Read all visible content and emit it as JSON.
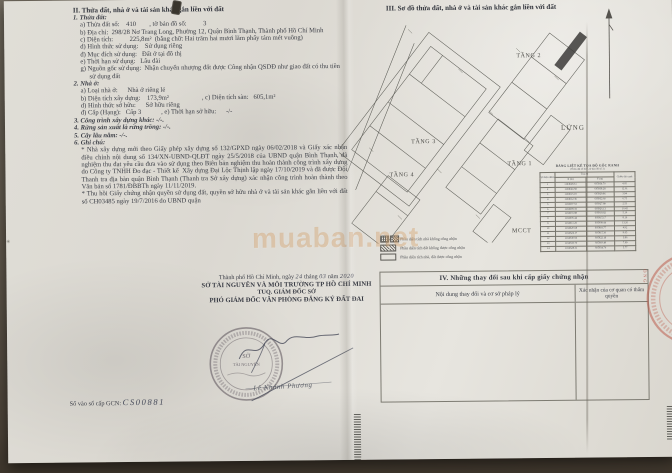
{
  "document": {
    "section2": {
      "heading": "II. Thửa đất, nhà ở và tài sản khác gắn liền với đất",
      "parcel": {
        "title": "1. Thửa đất:",
        "lines": [
          "a) Thửa đất số:    410        , tờ bản đồ số:          3",
          "b) Địa chỉ:  298/28 Nơ Trang Long, Phường 12, Quận Bình Thạnh, Thành phố Hồ Chí Minh",
          "c) Diện tích:          225,8m²  (bằng chữ: Hai trăm hai mươi lăm phẩy tám mét vuông)",
          "d) Hình thức sử dụng:    Sử dụng riêng",
          "đ) Mục đích sử dụng:   Đất ở tại đô thị",
          "e) Thời hạn sử dụng:   Lâu dài",
          "g) Nguồn gốc sử dụng:  Nhận chuyển nhượng đất được Công nhận QSDĐ như giao đất có thu tiền sử dụng đất"
        ]
      },
      "house": {
        "title": "2. Nhà ở:",
        "lines": [
          "a) Loại nhà ở:      Nhà ở riêng lẻ",
          "b) Diện tích xây dựng:    173,9m²                    , c) Diện tích sàn:   605,1m²",
          "d) Hình thức sở hữu:      Sở hữu riêng",
          "đ) Cấp (Hạng):   Cấp 3            , e) Thời hạn sở hữu:      -/-"
        ]
      },
      "other_constructions": "3. Công trình xây dựng khác: -/-.",
      "forest": "4. Rừng sản xuất là rừng trồng: -/-.",
      "perennial": "5. Cây lâu năm: -/-.",
      "notes_title": "6. Ghi chú:",
      "notes": [
        "* Nhà xây dựng mới theo Giấy phép xây dựng số 132/GPXD ngày 06/02/2018 và Giấy xác nhận điều chỉnh nội dung số 134/XN-UBND-QLĐT ngày 25/5/2018 của UBND quận Bình Thạnh, đã nghiệm thu đạt yêu cầu đưa vào sử dụng theo Biên bản nghiệm thu hoàn thành công trình xây dựng do Công ty TNHH Đo đạc - Thiết kế  Xây dựng Đại Lộc Thịnh lập ngày 17/10/2019 và đã được Đội Thanh tra địa bàn quận Bình Thạnh (Thanh tra Sở xây dựng) xác nhận công trình hoàn thành theo Văn bản số 1781/ĐBBTh ngày 11/11/2019.",
        "* Thu hồi Giấy chứng nhận quyền sử dụng đất, quyền sở hữu nhà ở và tài sản khác gắn liền với đất số CH03485 ngày 19/7/2016 do UBND quận"
      ]
    },
    "signature_block": {
      "date_pre": "Thành phố Hồ Chí Minh, ngày",
      "date_day": "24",
      "date_thang": "tháng",
      "date_month": "03",
      "date_nam": "năm",
      "date_year": "2020",
      "org": "SỞ TÀI NGUYÊN VÀ MÔI TRƯỜNG TP HỒ CHÍ MINH",
      "delegation": "TUQ. GIÁM ĐỐC SỞ",
      "signer_title": "PHÓ GIÁM ĐỐC VĂN PHÒNG ĐĂNG KÝ ĐẤT ĐAI",
      "signer_name": "Lê Khánh Phương",
      "stamp_line1": "SỞ",
      "stamp_line2": "TÀI NGUYÊN",
      "book_label": "Số vào sổ cấp GCN: ",
      "book_value": "CS00881"
    },
    "section3": {
      "heading": "III. Sơ đồ thửa đất, nhà ở và tài sản khác gắn liền với đất",
      "floor_labels": {
        "t2": "TẦNG 2",
        "lung": "LỬNG",
        "t3": "TẦNG 3",
        "t1": "TẦNG 1",
        "t4": "TẦNG 4",
        "mcct": "MCCT"
      },
      "coord_table": {
        "title": "BẢNG LIỆT KÊ TỌA ĐỘ GỐC RANH",
        "subtitle": "(Thửa đất số 410, tờ bản đồ số 3)",
        "col_point": "Số hiệu điểm",
        "col_coord": "Tọa độ",
        "col_x": "X (m)",
        "col_y": "Y (m)",
        "col_len": "Chiều dài cạnh",
        "rows": [
          [
            "1",
            "1194628.31",
            "605934.70",
            "4.05"
          ],
          [
            "2",
            "1194624.58",
            "605938.28",
            "12.61"
          ],
          [
            "3",
            "1194615.19",
            "605929.86",
            "3.94"
          ],
          [
            "4",
            "1194612.36",
            "605932.60",
            "6.75"
          ],
          [
            "5",
            "1194607.53",
            "605927.89",
            "2.53"
          ],
          [
            "6",
            "1194609.35",
            "605926.13",
            "10.45"
          ],
          [
            "7",
            "1194601.88",
            "605918.82",
            "5.10"
          ],
          [
            "8",
            "1194605.44",
            "605915.17",
            "8.16"
          ],
          [
            "9",
            "1194611.25",
            "605909.44",
            "13.26"
          ],
          [
            "10",
            "1194620.68",
            "605918.77",
            "4.92"
          ],
          [
            "11",
            "1194624.17",
            "605915.30",
            "9.65"
          ],
          [
            "12",
            "1194630.93",
            "605922.18",
            "3.86"
          ],
          [
            "13",
            "1194633.70",
            "605919.49",
            "7.69"
          ],
          [
            "14",
            "1194628.31",
            "605934.70",
            "5.77"
          ]
        ]
      },
      "legend": {
        "item1": "Phần diện tích nhà không công nhận",
        "item2": "Phần diện tích đất không được công nhận",
        "item3": "Phần diện tích nhà, đất được công nhận"
      }
    },
    "section4": {
      "heading": "IV. Những thay đổi sau khi cấp giấy chứng nhận",
      "col1": "Nội dung thay đổi và cơ sở pháp lý",
      "col2": "Xác nhận của cơ quan có thẩm quyền"
    },
    "watermark": "muaban.net",
    "edge_stamp_letters": "ÒNG"
  }
}
